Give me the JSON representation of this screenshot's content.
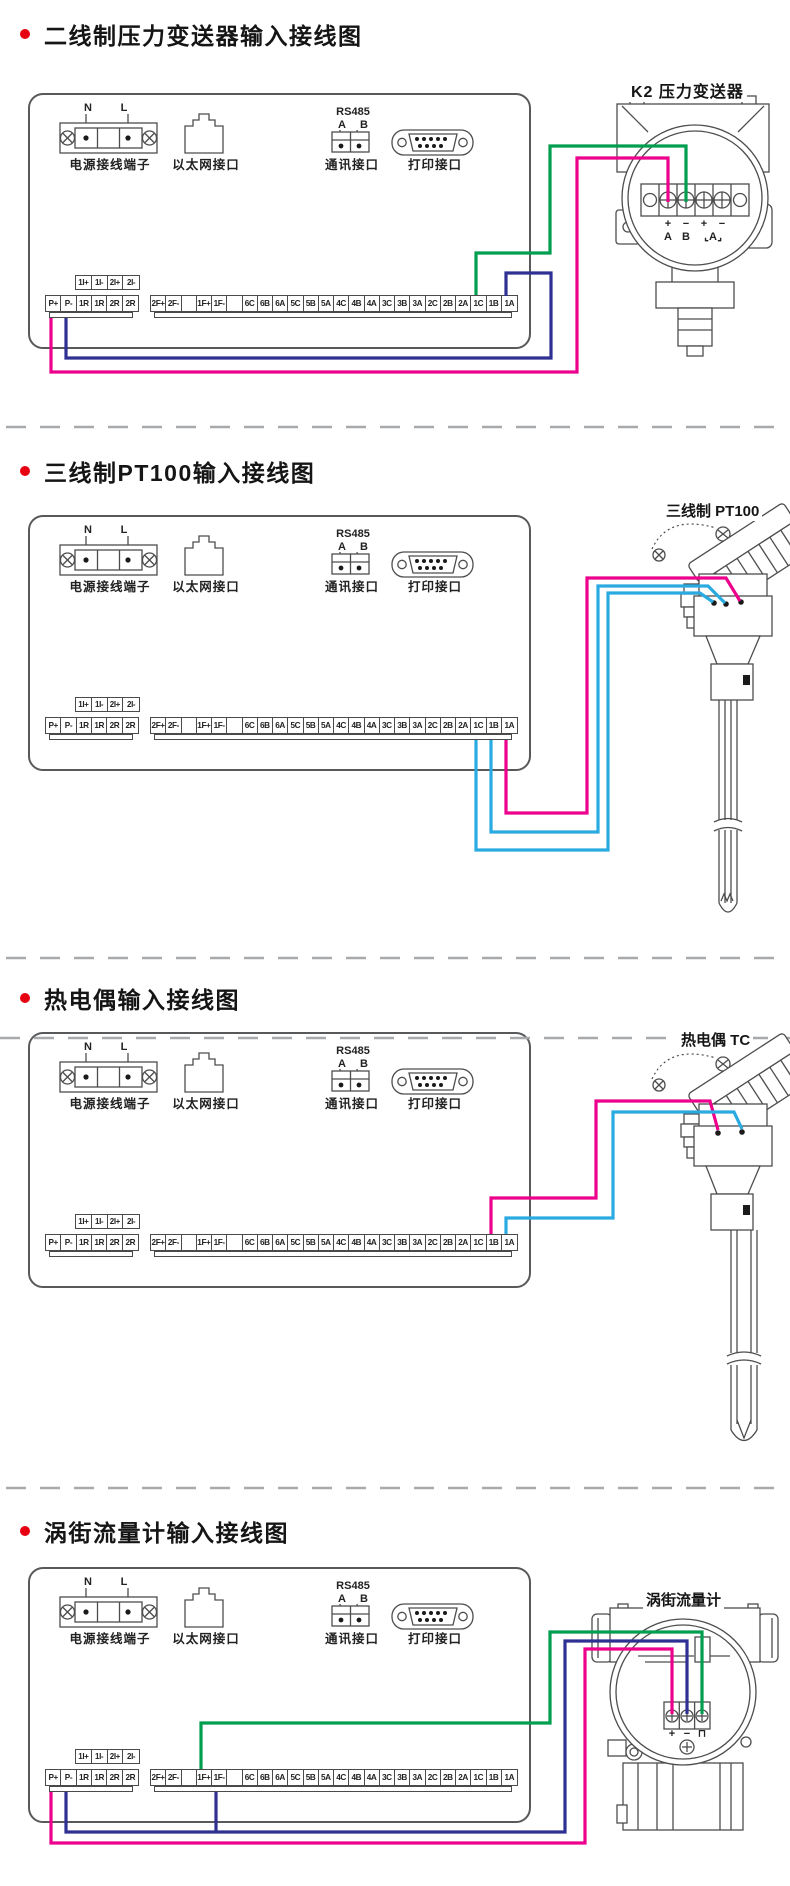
{
  "colors": {
    "magenta": "#EC008C",
    "blue": "#2E3192",
    "cyan": "#29ABE2",
    "green": "#009E4F",
    "bullet": "#E60012",
    "line": "#4d4d4d",
    "divider": "#A7A9AC",
    "text": "#1a1a1a"
  },
  "panel": {
    "n": "N",
    "l": "L",
    "rs485": "RS485",
    "rs485_a": "A",
    "rs485_b": "B",
    "power_label": "电源接线端子",
    "ethernet_label": "以太网接口",
    "comm_label": "通讯接口",
    "print_label": "打印接口",
    "strip_top": [
      "1I+",
      "1I-",
      "2I+",
      "2I-"
    ],
    "strip_left": [
      "P+",
      "P-",
      "1R",
      "1R",
      "2R",
      "2R"
    ],
    "strip_right": [
      "2F+",
      "2F-",
      "",
      "1F+",
      "1F-",
      "",
      "6C",
      "6B",
      "6A",
      "5C",
      "5B",
      "5A",
      "4C",
      "4B",
      "4A",
      "3C",
      "3B",
      "3A",
      "2C",
      "2B",
      "2A",
      "1C",
      "1B",
      "1A"
    ]
  },
  "sections": [
    {
      "title": "二线制压力变送器输入接线图",
      "device": {
        "label": "K2 压力变送器",
        "terminals": [
          "+",
          "−",
          "+",
          "−"
        ],
        "row2": [
          "A",
          "B",
          "⌞A⌟"
        ]
      }
    },
    {
      "title": "三线制PT100输入接线图",
      "device": {
        "label": "三线制 PT100"
      }
    },
    {
      "title": "热电偶输入接线图",
      "device": {
        "label": "热电偶 TC"
      }
    },
    {
      "title": "涡街流量计输入接线图",
      "device": {
        "label": "涡街流量计",
        "terminals": [
          "+",
          "−",
          "⊓"
        ]
      }
    }
  ]
}
